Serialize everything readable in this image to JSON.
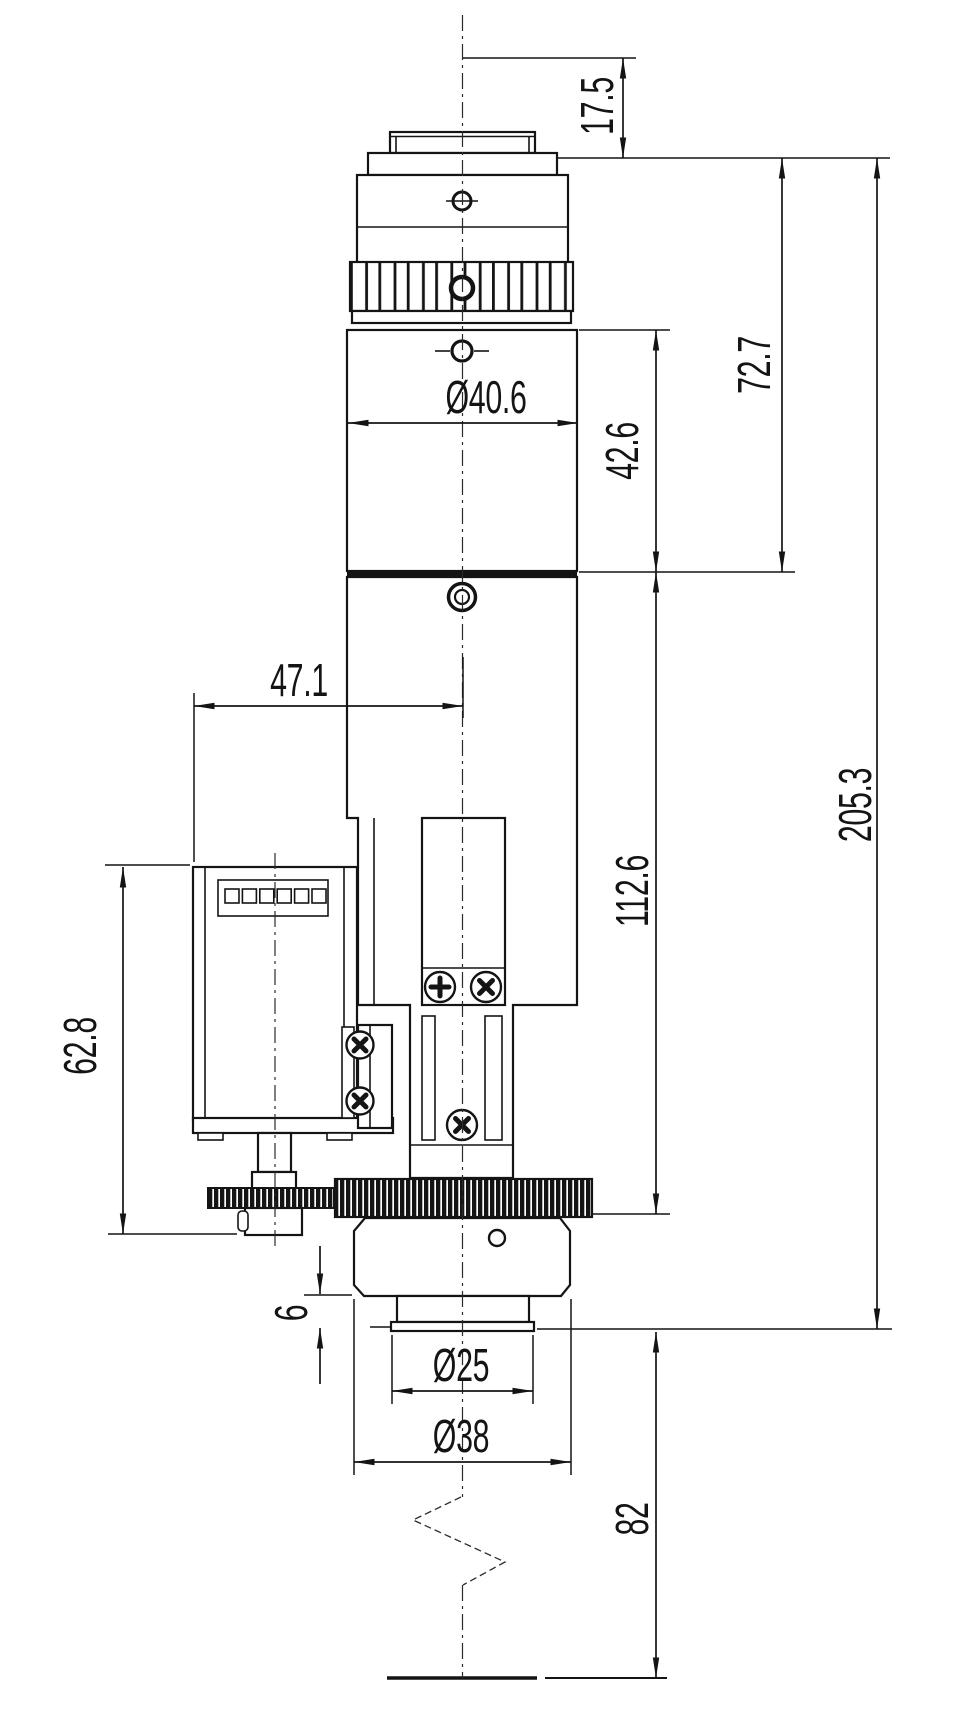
{
  "drawing": {
    "type": "mechanical dimension drawing",
    "view": "side elevation of motorized lens module",
    "units": "mm",
    "line_color": "#141414",
    "background_color": "#ffffff",
    "dimensions": {
      "mount_stub_height": "17.5",
      "head_assembly_height": "72.7",
      "upper_body_height": "42.6",
      "body_diameter": "Ø40.6",
      "motor_center_offset": "47.1",
      "lower_body_height": "112.6",
      "motor_assembly_height": "62.8",
      "overall_length": "205.3",
      "front_step_height": "6",
      "front_flange_diameter": "Ø25",
      "front_barrel_diameter": "Ø38",
      "working_distance": "82"
    }
  }
}
